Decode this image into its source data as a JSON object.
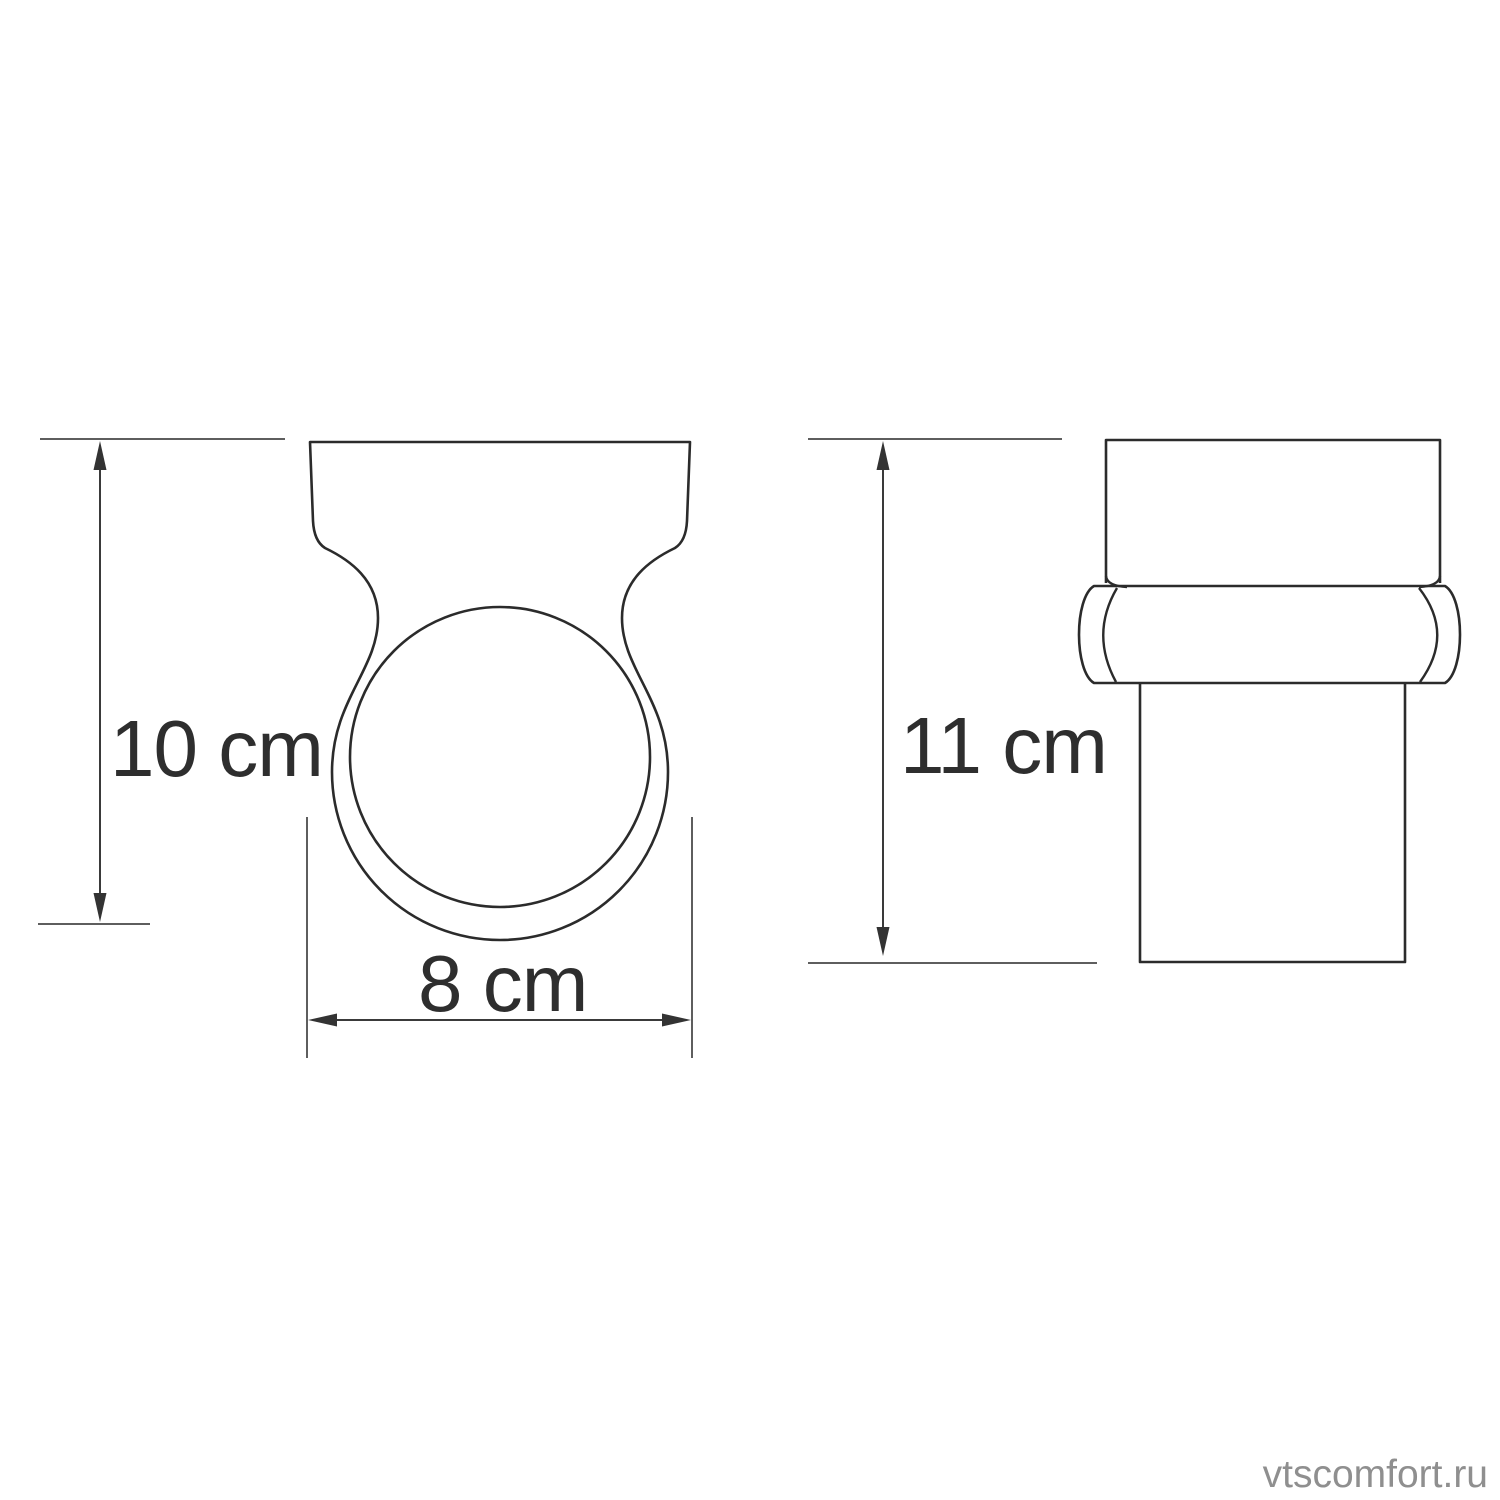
{
  "drawing": {
    "type": "technical-dimension-diagram",
    "views": {
      "front": {
        "description": "wall-mount holder ring, front view",
        "dimensions": {
          "height": {
            "value": "10 cm"
          },
          "width": {
            "value": "8 cm"
          }
        }
      },
      "side": {
        "description": "glass tumbler in holder, side view",
        "dimensions": {
          "height": {
            "value": "11 cm"
          }
        }
      }
    },
    "colors": {
      "background": "#ffffff",
      "outline": "#2b2b2b",
      "dimension_line": "#3a3a3a",
      "extension_line": "#5e5e5e",
      "arrowhead": "#333333",
      "label_text": "#2e2e2e",
      "watermark": "#8f8f8f"
    }
  },
  "watermark": {
    "text": "vtscomfort.ru"
  }
}
